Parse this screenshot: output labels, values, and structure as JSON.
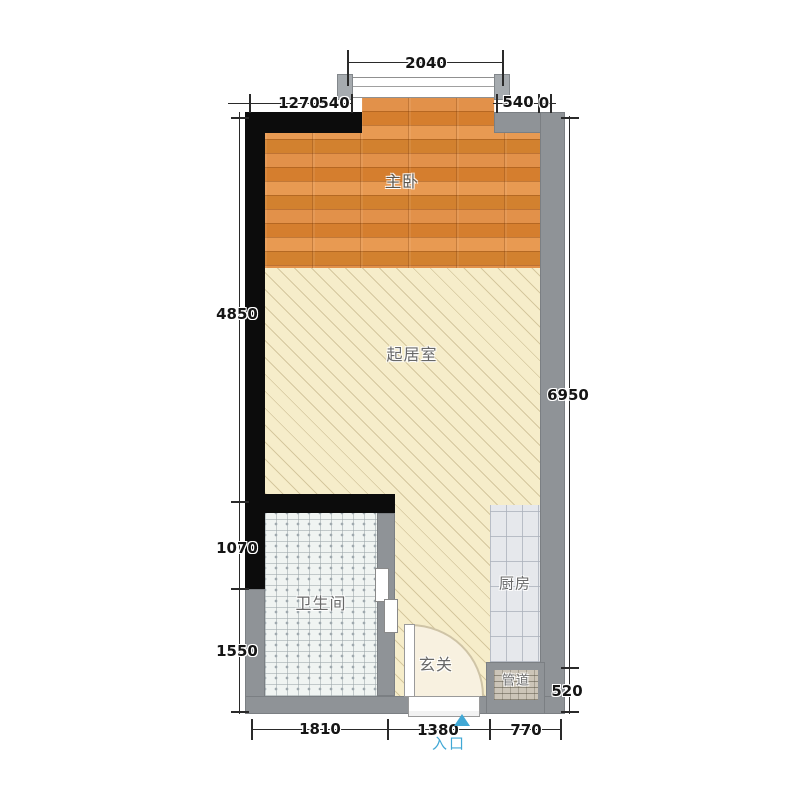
{
  "rooms": {
    "bedroom": "主卧",
    "living_room": "起居室",
    "bathroom": "卫生间",
    "kitchen": "厨房",
    "foyer": "玄关",
    "duct": "管道"
  },
  "entrance": {
    "label": "入口"
  },
  "dims": {
    "top": "2040",
    "top2": [
      "1270",
      "540",
      "540",
      "0"
    ],
    "left": [
      "4850",
      "1070",
      "1550"
    ],
    "right": [
      "6950",
      "520"
    ],
    "bottom": [
      "1810",
      "1380",
      "770"
    ]
  },
  "colors": {
    "wall_dark": "#0c0c0c",
    "wall_gray": "#8f9397",
    "wood_floor": "#dc8a3e",
    "living_floor": "#f6edca",
    "bathroom_tile": "#f0f4f2",
    "kitchen_tile": "#e6e8ec",
    "duct_fill": "#ccc5b8",
    "entrance_accent": "#41a8d5",
    "dim_text": "#151515",
    "room_label": "#686868"
  }
}
